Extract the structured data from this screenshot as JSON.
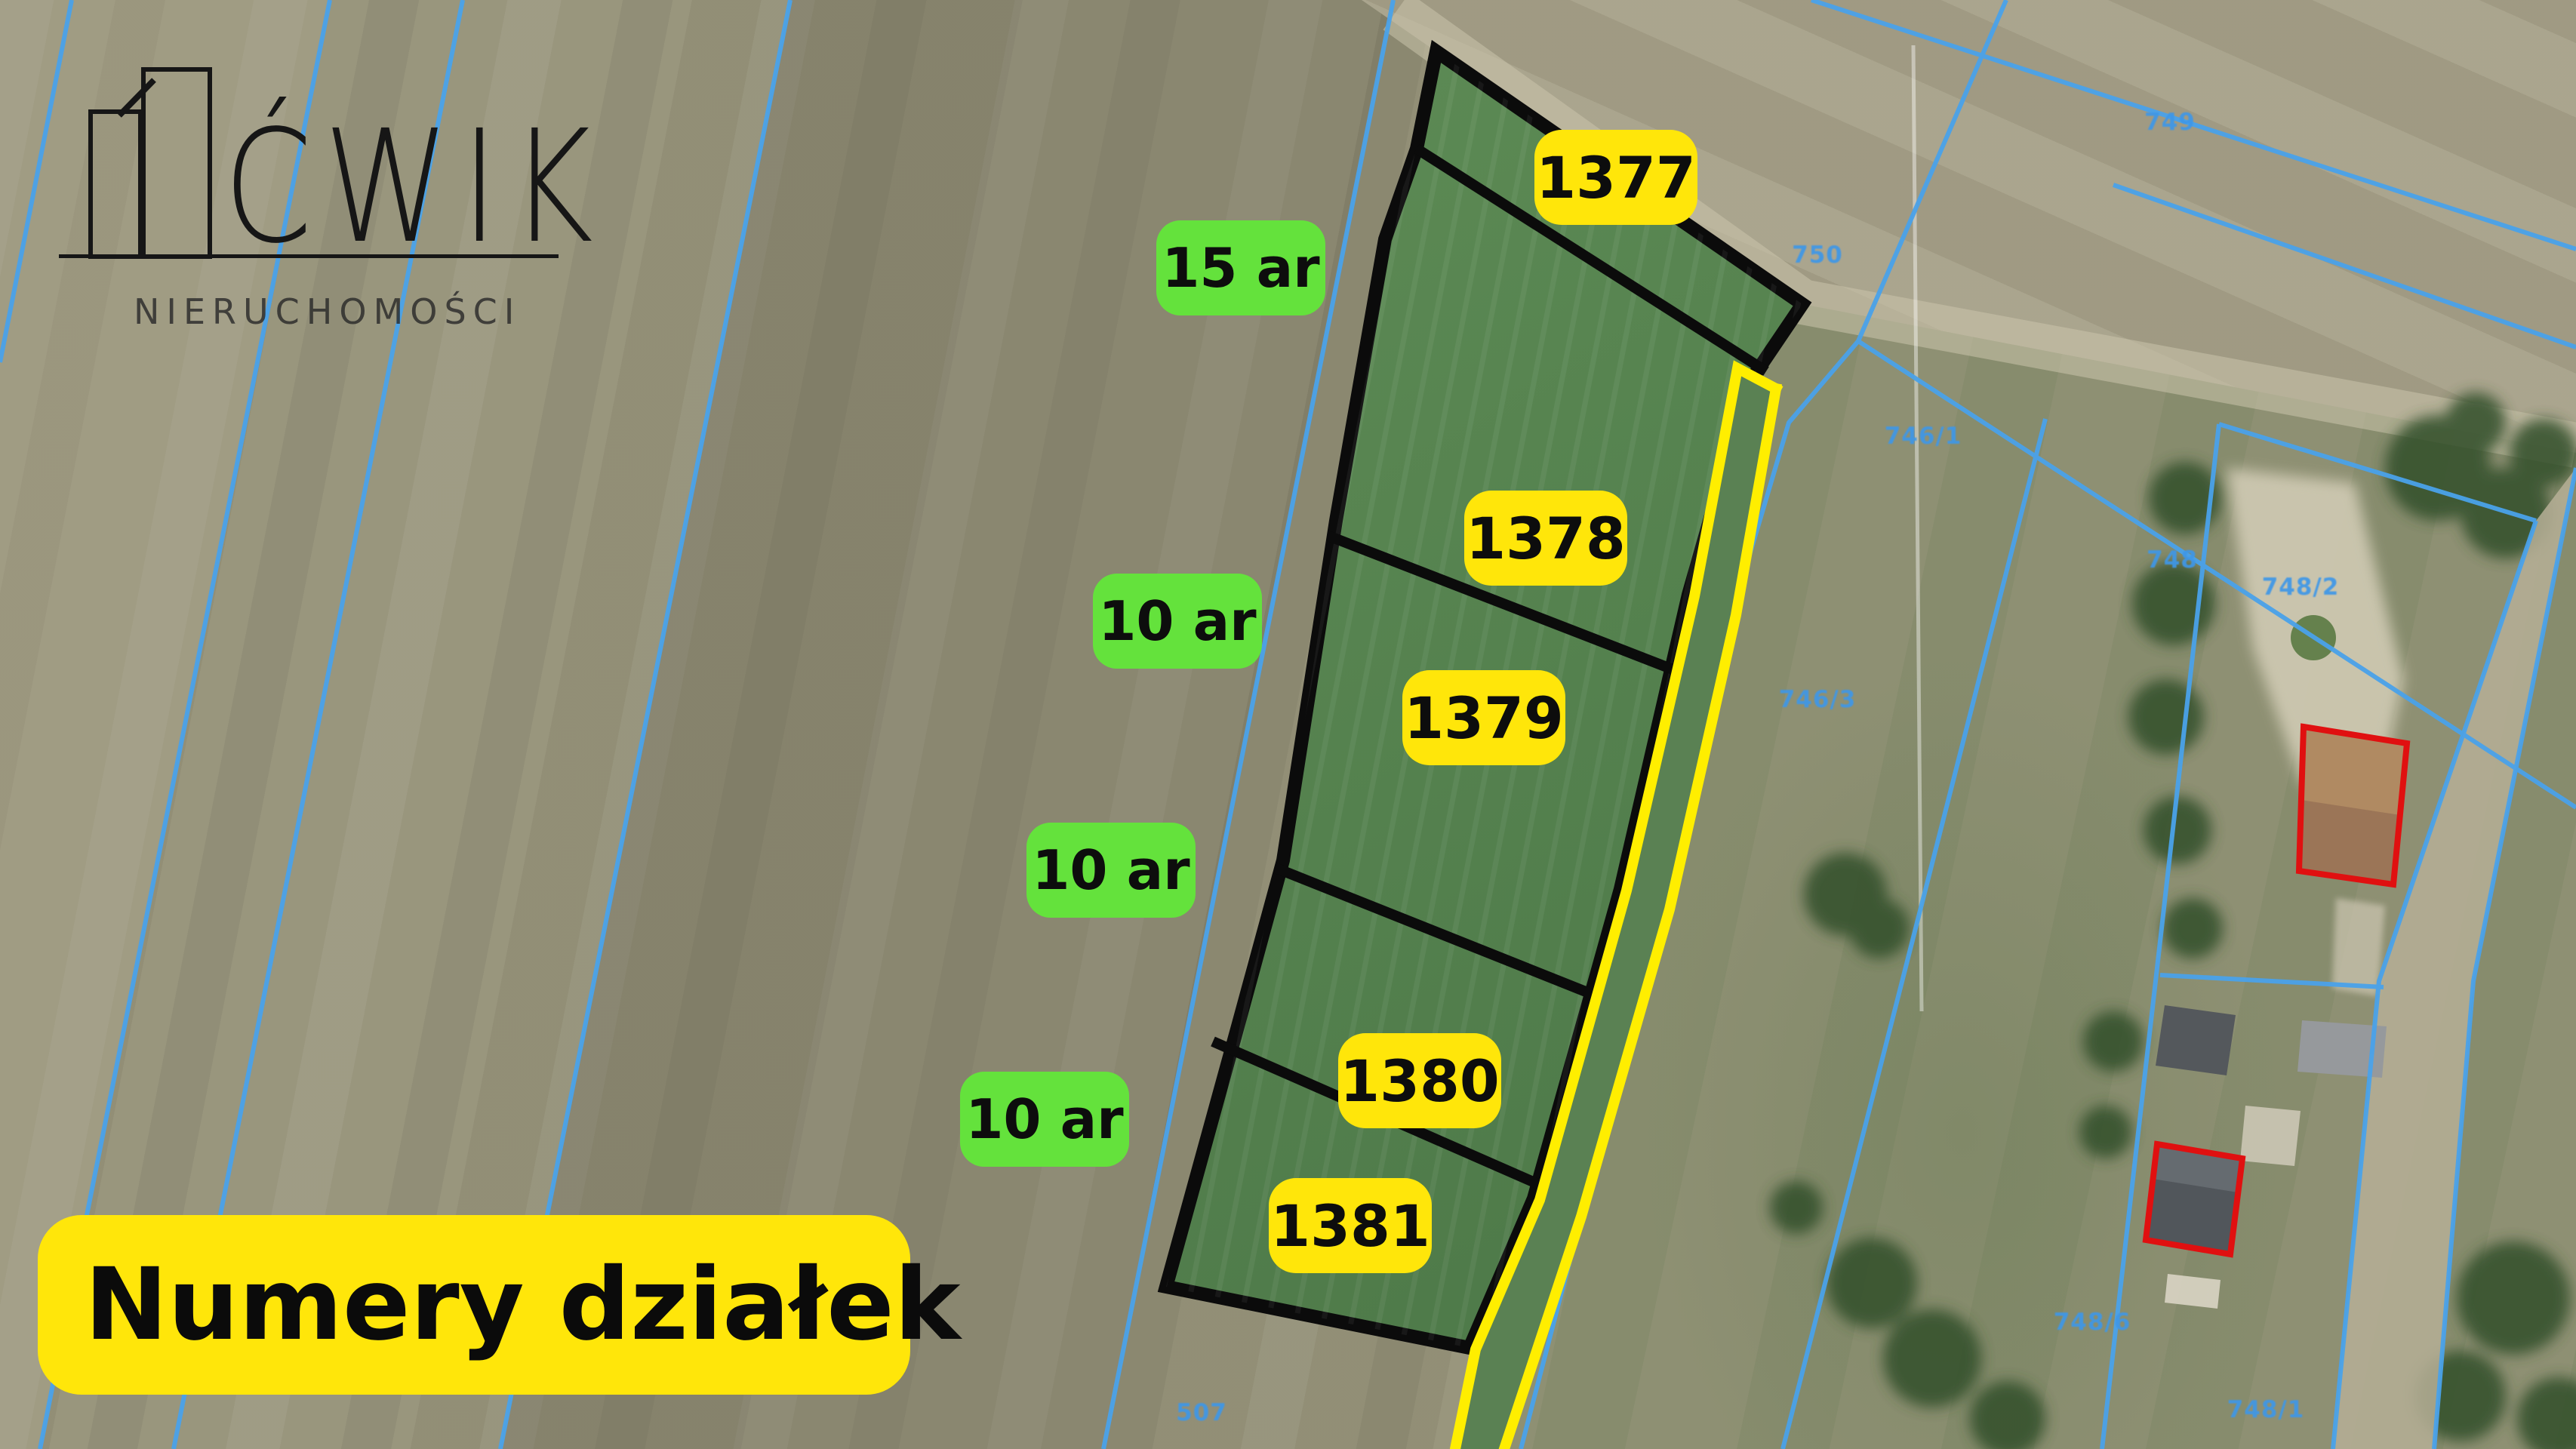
{
  "brand": {
    "name": "ĆWIK",
    "subtitle": "NIERUCHOMOŚCI"
  },
  "title": "Numery działek",
  "parcels": [
    {
      "number": "1377",
      "area": ""
    },
    {
      "number": "1378",
      "area": "15 ar"
    },
    {
      "number": "1379",
      "area": "10 ar"
    },
    {
      "number": "1380",
      "area": "10 ar"
    },
    {
      "number": "1381",
      "area": "10 ar"
    }
  ],
  "cadastral_labels": {
    "c749": "749",
    "c750": "750",
    "c748": "748",
    "c746_1": "746/1",
    "c746_3": "746/3",
    "c748_2": "748/2",
    "c748_6": "748/6",
    "c748_1": "748/1",
    "c507": "507"
  },
  "colors": {
    "badge_yellow": "#ffe60a",
    "badge_green": "#64e23c",
    "road_yellow": "#ffee00",
    "cadastral_blue": "#4aa2ea",
    "outline_black": "#0b0b0b",
    "parcel_green": "#56804f",
    "building_outline_red": "#e01010"
  }
}
